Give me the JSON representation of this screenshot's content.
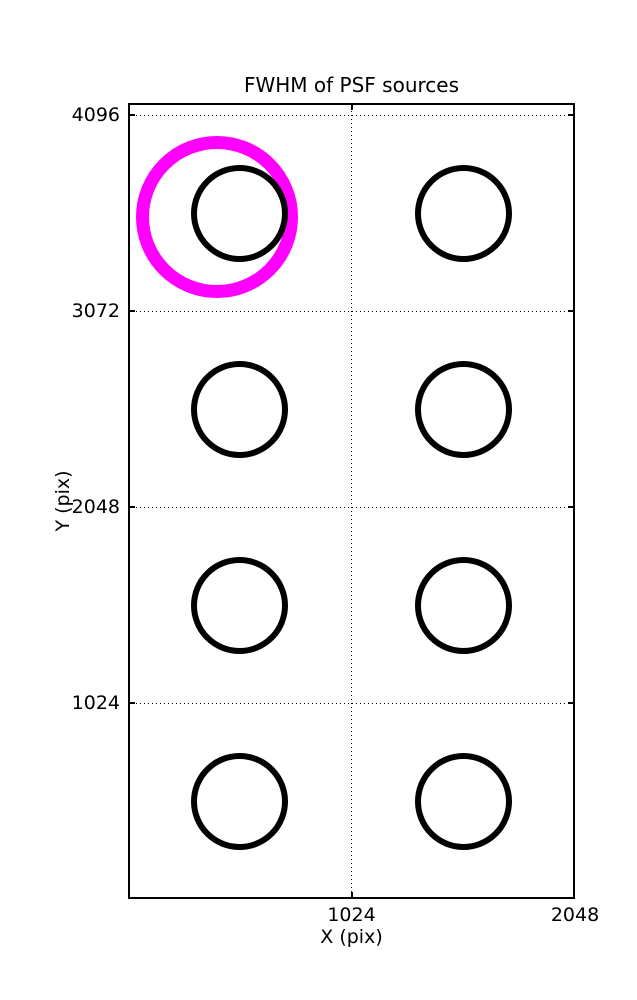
{
  "title": "FWHM of PSF sources",
  "axes": {
    "xlabel": "X (pix)",
    "ylabel": "Y (pix)"
  },
  "chart_data": {
    "type": "scatter",
    "title": "FWHM of PSF sources",
    "xlabel": "X (pix)",
    "ylabel": "Y (pix)",
    "xlim": [
      0,
      2048
    ],
    "ylim": [
      0,
      4160
    ],
    "x_ticks": [
      1024,
      2048
    ],
    "y_ticks": [
      1024,
      2048,
      3072,
      4096
    ],
    "grid": true,
    "grid_style": "dotted",
    "legend": false,
    "axis_color": "#000000",
    "series": [
      {
        "name": "psf-sources",
        "marker": "open-circle",
        "color": "#000000",
        "marker_diameter_px": 97,
        "line_width_px": 6,
        "zorder": 3,
        "points": [
          {
            "x": 512,
            "y": 3584
          },
          {
            "x": 1536,
            "y": 3584
          },
          {
            "x": 512,
            "y": 2560
          },
          {
            "x": 1536,
            "y": 2560
          },
          {
            "x": 512,
            "y": 1536
          },
          {
            "x": 1536,
            "y": 1536
          },
          {
            "x": 512,
            "y": 512
          },
          {
            "x": 1536,
            "y": 512
          }
        ]
      },
      {
        "name": "highlighted-source",
        "marker": "open-circle",
        "color": "#ff00ff",
        "marker_diameter_px": 162,
        "line_width_px": 13,
        "zorder": 2,
        "points": [
          {
            "x": 410,
            "y": 3562
          }
        ]
      }
    ]
  }
}
